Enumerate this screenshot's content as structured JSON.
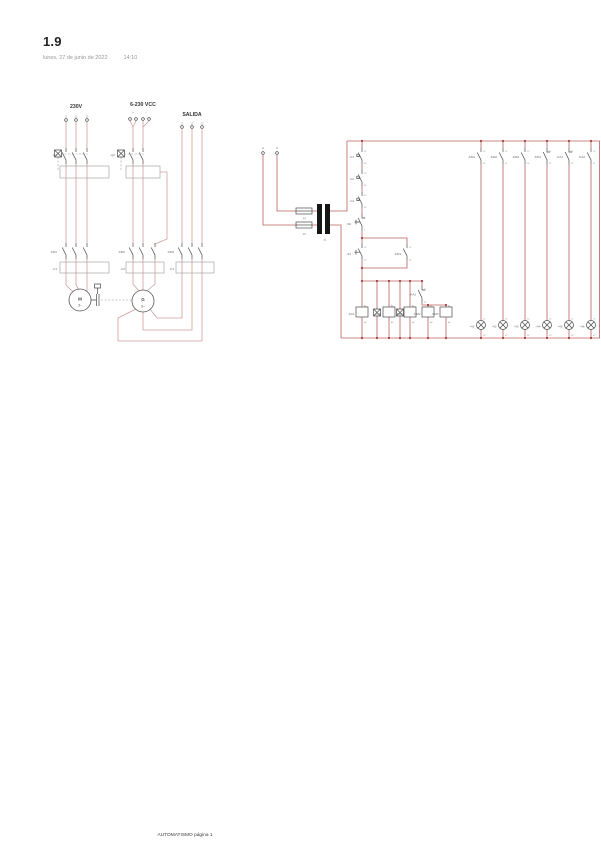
{
  "page": {
    "title": "1.9",
    "date": "lunes, 27 de junio de 2022",
    "time": "14:10",
    "footer": "AUTOMATISMO página 1"
  },
  "colors": {
    "power_wire": "#d49c9c",
    "control_wire": "#bb6060",
    "junction_dot": "#a03a3a",
    "component": "#4a4a4a",
    "transformer": "#161616"
  },
  "power": {
    "titles": [
      "230V",
      "6-230 VCC",
      "SALIDA"
    ],
    "g1": {
      "breaker": "-Q1",
      "contactor": "-KM1",
      "thermal": "-F1",
      "ph": [
        "L1",
        "L2",
        "L3"
      ]
    },
    "g2": {
      "breaker": "-Q2",
      "contactor": "-KM2",
      "thermal": "-F2",
      "plus": "+",
      "minus": "−"
    },
    "g3": {
      "contactor": "-KM3",
      "thermal": "-F3",
      "ph": [
        "L1",
        "L2",
        "L3"
      ]
    },
    "motor": {
      "sym": "M",
      "ph": "3~"
    },
    "generator": {
      "sym": "G",
      "ph": "3~"
    }
  },
  "control": {
    "src": [
      "L1",
      "N"
    ],
    "fuses": [
      "-F4",
      "-F5"
    ],
    "transformer": "-T1",
    "chain": [
      {
        "label": "-F1",
        "t1": "95",
        "t2": "96"
      },
      {
        "label": "-F2",
        "t1": "95",
        "t2": "96"
      },
      {
        "label": "-F3",
        "t1": "95",
        "t2": "96"
      },
      {
        "label": "-S0",
        "t1": "1",
        "t2": "2"
      },
      {
        "label": "-S1",
        "t1": "13",
        "t2": "14"
      },
      {
        "label": "-KM1",
        "t1": "13",
        "t2": "14"
      },
      {
        "label": "-KA2",
        "t1": "21",
        "t2": "22"
      }
    ],
    "coils": [
      {
        "label": "-KA1",
        "t1": "A1",
        "t2": "A2"
      },
      {
        "label": "-KM1",
        "t1": "A1",
        "t2": "A2"
      },
      {
        "label": "-KA2",
        "t1": "A1",
        "t2": "A2"
      },
      {
        "label": "-KM2",
        "t1": "A1",
        "t2": "A2"
      },
      {
        "label": "-KM3",
        "t1": "A1",
        "t2": "A2"
      }
    ],
    "lamp_contacts": [
      {
        "label": "-KM1",
        "t1": "13",
        "t2": "14"
      },
      {
        "label": "-KM2",
        "t1": "13",
        "t2": "14"
      },
      {
        "label": "-KM3",
        "t1": "13",
        "t2": "14"
      },
      {
        "label": "-KM1",
        "t1": "21",
        "t2": "22"
      },
      {
        "label": "-KA1",
        "t1": "21",
        "t2": "22"
      },
      {
        "label": "-KA2",
        "t1": "13",
        "t2": "14"
      }
    ],
    "lamps": [
      {
        "label": "-H1",
        "t1": "X1",
        "t2": "X2"
      },
      {
        "label": "-H2",
        "t1": "X1",
        "t2": "X2"
      },
      {
        "label": "-H3",
        "t1": "X1",
        "t2": "X2"
      },
      {
        "label": "-H4",
        "t1": "X1",
        "t2": "X2"
      },
      {
        "label": "-H5",
        "t1": "X1",
        "t2": "X2"
      },
      {
        "label": "-H6",
        "t1": "X1",
        "t2": "X2"
      }
    ]
  }
}
